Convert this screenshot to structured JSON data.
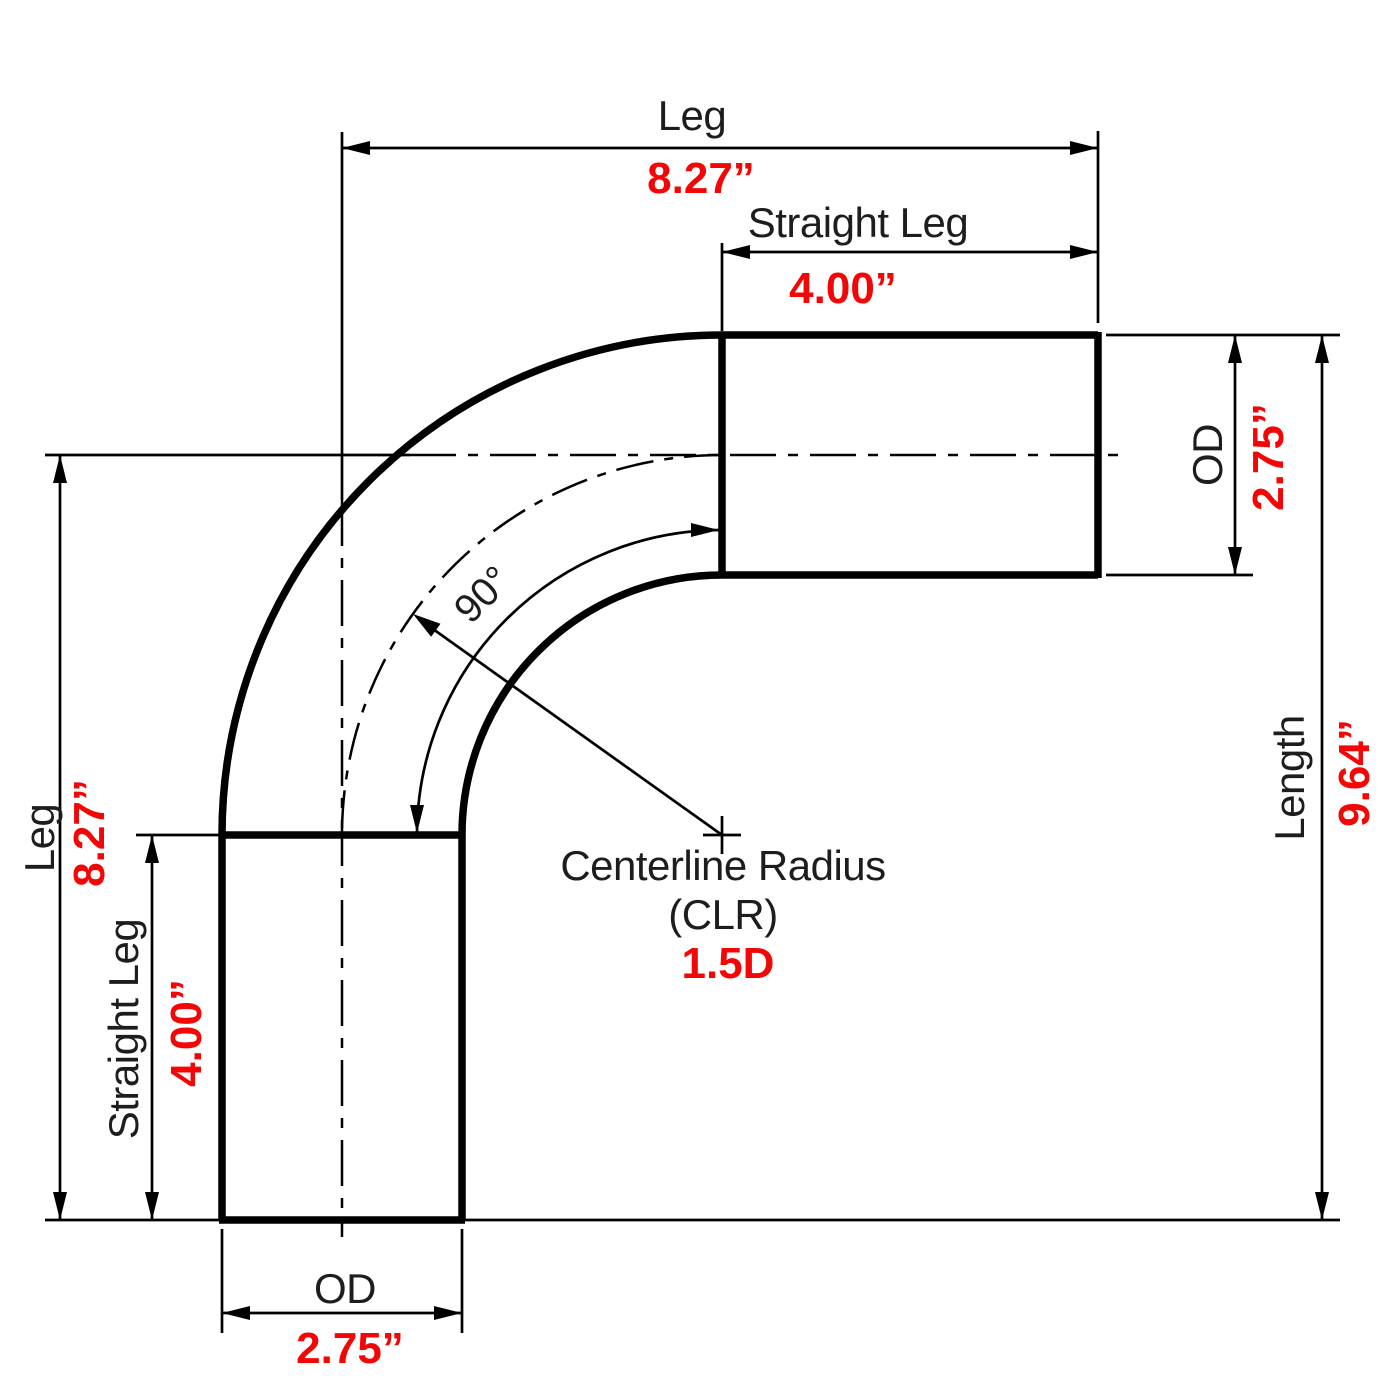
{
  "drawing": {
    "description": "90 degree bend tube dimension drawing",
    "dims": {
      "top_leg": {
        "label": "Leg",
        "value": "8.27”"
      },
      "top_straight_leg": {
        "label": "Straight Leg",
        "value": "4.00”"
      },
      "right_od": {
        "label": "OD",
        "value": "2.75”"
      },
      "right_length": {
        "label": "Length",
        "value": "9.64”"
      },
      "left_leg": {
        "label": "Leg",
        "value": "8.27”"
      },
      "left_straight_leg": {
        "label": "Straight Leg",
        "value": "4.00”"
      },
      "bottom_od": {
        "label": "OD",
        "value": "2.75”"
      },
      "bend_angle": {
        "value": "90°"
      },
      "clr": {
        "label_line1": "Centerline Radius",
        "label_line2": "(CLR)",
        "value": "1.5D"
      }
    },
    "colors": {
      "line": "#000000",
      "label": "#1d1d1f",
      "value": "#f40606"
    }
  }
}
